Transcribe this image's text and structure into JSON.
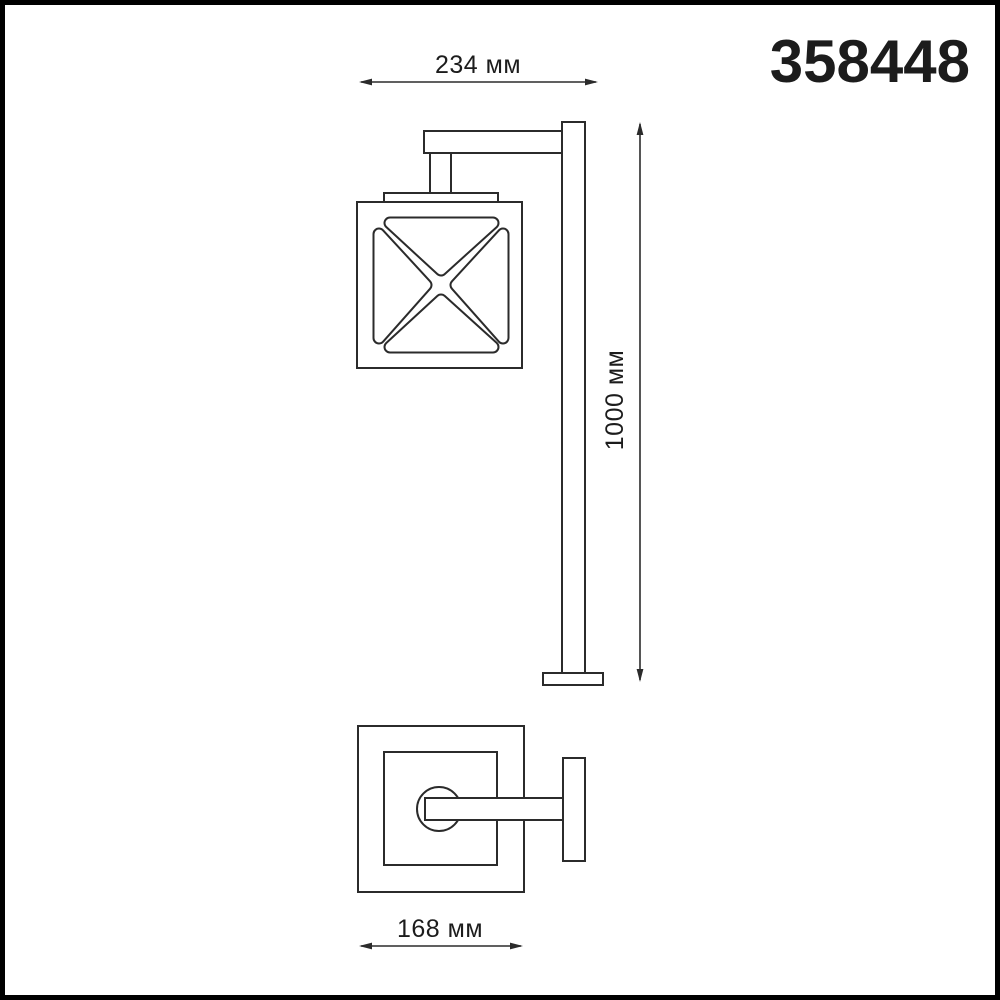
{
  "product": {
    "code": "358448"
  },
  "drawing": {
    "line_color": "#2b2b2b",
    "text_color": "#1c1c1c",
    "background_color": "#ffffff",
    "frame_color": "#000000",
    "dimensions": {
      "width": {
        "label": "234 мм",
        "value": 234,
        "unit": "мм"
      },
      "height": {
        "label": "1000 мм",
        "value": 1000,
        "unit": "мм"
      },
      "base_width": {
        "label": "168 мм",
        "value": 168,
        "unit": "мм"
      }
    }
  }
}
